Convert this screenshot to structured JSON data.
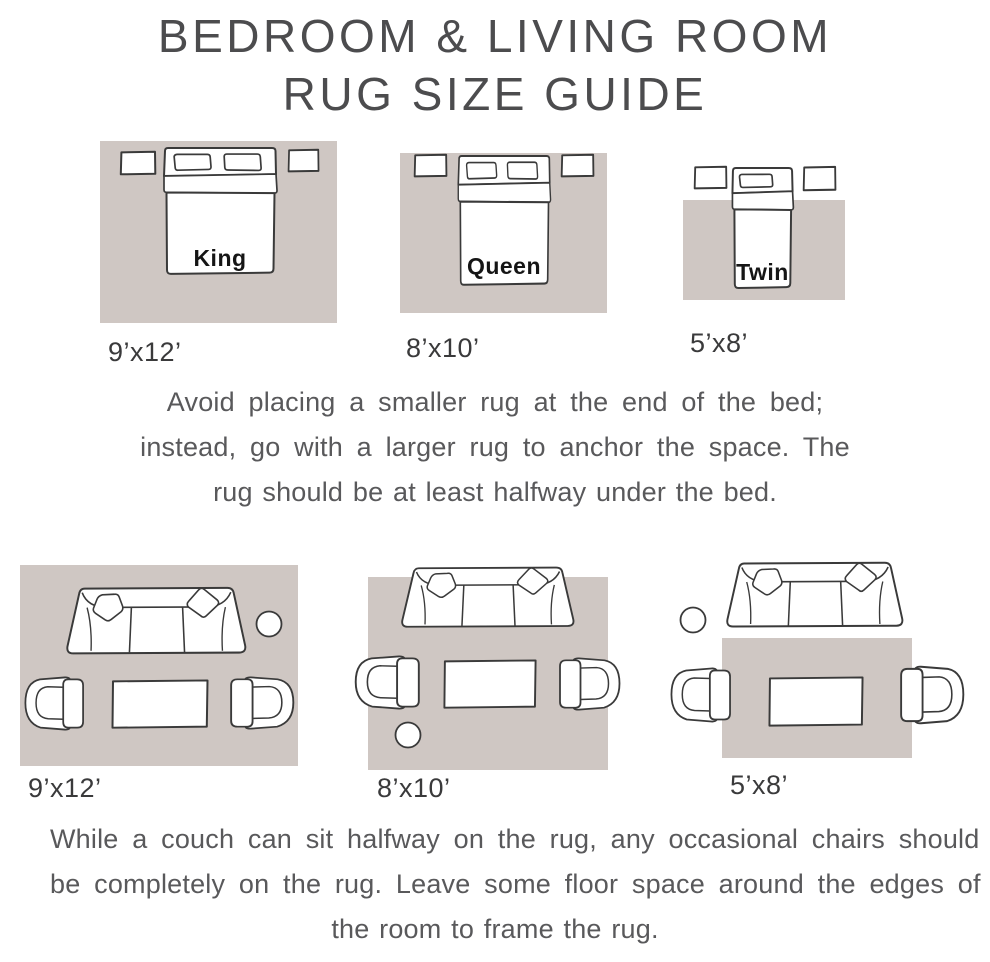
{
  "title": {
    "line1": "BEDROOM & LIVING ROOM",
    "line2": "RUG SIZE GUIDE"
  },
  "bedroom_section": {
    "diagrams": [
      {
        "bed_label": "King",
        "rug_size": "9’x12’"
      },
      {
        "bed_label": "Queen",
        "rug_size": "8’x10’"
      },
      {
        "bed_label": "Twin",
        "rug_size": "5’x8’"
      }
    ],
    "tip_lines": [
      "Avoid placing a smaller rug at the end of the bed;",
      "instead, go with a larger rug to anchor the space. The",
      "rug should be at least halfway under the bed."
    ]
  },
  "livingroom_section": {
    "diagrams": [
      {
        "rug_size": "9’x12’"
      },
      {
        "rug_size": "8’x10’"
      },
      {
        "rug_size": "5’x8’"
      }
    ],
    "tip_lines": [
      "While a couch can sit halfway on the rug, any occasional chairs should",
      "be completely on the rug. Leave some floor space around the edges of",
      "the room to frame the rug."
    ]
  },
  "colors": {
    "rug": "#cfc7c3",
    "outline": "#3a3a3a",
    "title_text": "#4c4c4e",
    "body_text": "#59595b",
    "size_label_text": "#3a3a3b",
    "bed_label_text": "#151515"
  }
}
